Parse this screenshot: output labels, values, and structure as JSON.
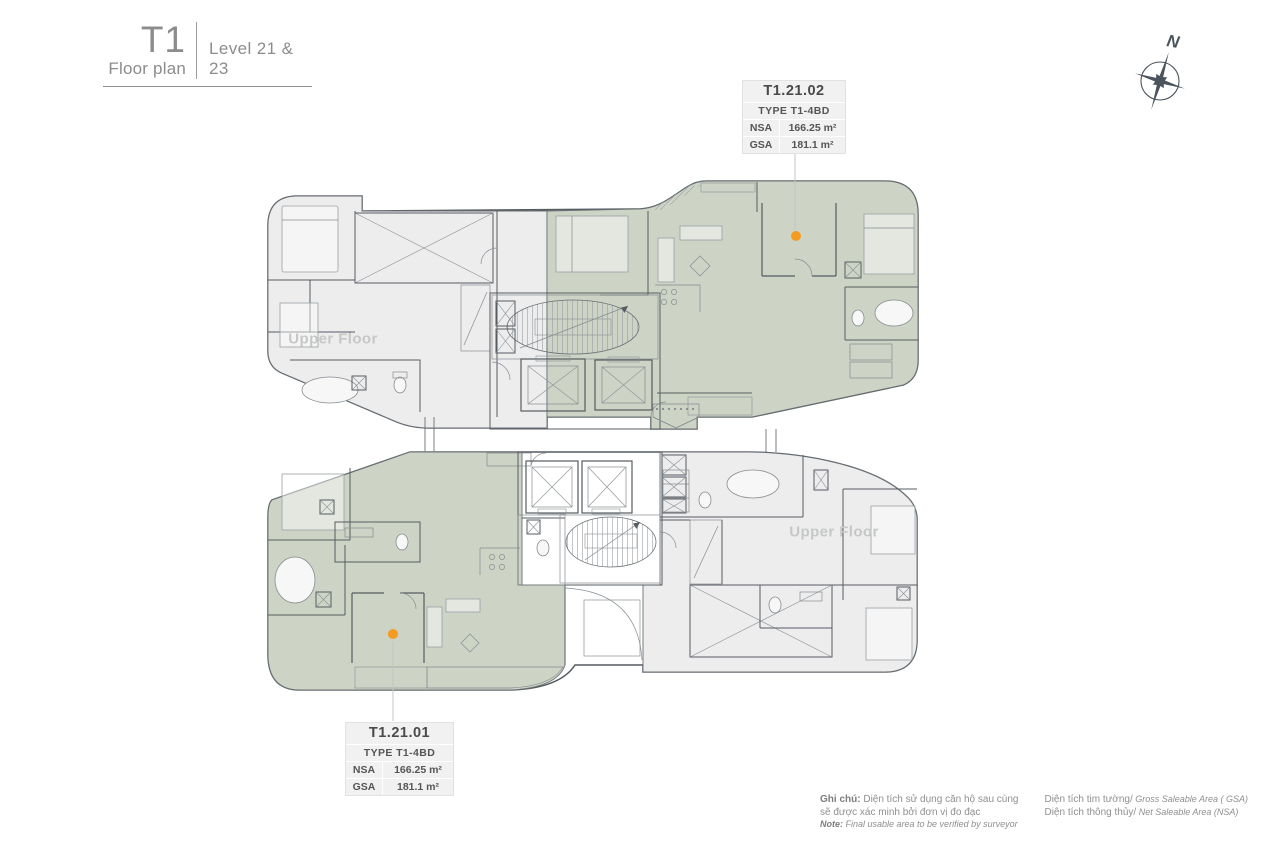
{
  "header": {
    "tower": "T1",
    "subtitle": "Floor plan",
    "level": "Level 21 & 23"
  },
  "compass": {
    "north_label": "N"
  },
  "units": [
    {
      "id": "T1.21.02",
      "type_label": "TYPE T1-4BD",
      "nsa_label": "NSA",
      "nsa_value": "166.25 m²",
      "gsa_label": "GSA",
      "gsa_value": "181.1 m²"
    },
    {
      "id": "T1.21.01",
      "type_label": "TYPE T1-4BD",
      "nsa_label": "NSA",
      "nsa_value": "166.25 m²",
      "gsa_label": "GSA",
      "gsa_value": "181.1 m²"
    }
  ],
  "plan": {
    "upper_floor_top": "Upper Floor",
    "upper_floor_bottom": "Upper Floor"
  },
  "notes": {
    "ghi_chu_bold": "Ghi chú:",
    "ghi_chu_rest": " Diện tích sử dụng căn hộ sau cùng",
    "ghi_chu_line2": "sẽ được xác minh bởi đơn vị đo đạc",
    "note_bold": "Note:",
    "note_rest": " Final usable area to be verified by surveyor",
    "gsa_vn": "Diện tích tim tường/",
    "gsa_en": " Gross Saleable Area ( GSA)",
    "nsa_vn": "Diện tích thông thủy/",
    "nsa_en": " Net Saleable Area (NSA)"
  },
  "colors": {
    "unit_fill": "#cdd3c5",
    "upper_floor_fill": "#ededee",
    "wall": "#565c60",
    "accent_orange": "#f59b20"
  }
}
